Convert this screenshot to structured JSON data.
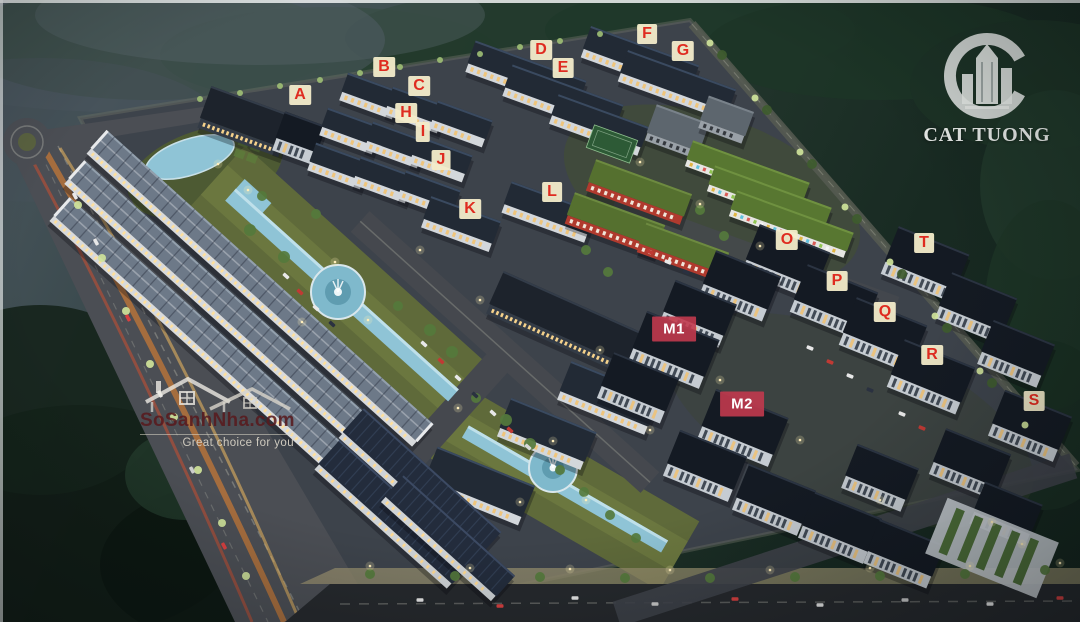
{
  "branding": {
    "logo_text": "CAT TUONG",
    "logo_icon": "circle-c-with-highrise-buildings",
    "logo_color": "#f2f4f2"
  },
  "watermark": {
    "site": "SoSanhNha.com",
    "tagline": "Great choice for you",
    "icon": "twin-house-outline",
    "site_color": "#581a1e",
    "tagline_color": "#d8d3c8"
  },
  "building_labels": {
    "letter_style": {
      "text_color": "#df2b20",
      "bg_color": "rgba(243,236,202,0.95)"
    },
    "block_style": {
      "text_color": "#ffffff",
      "bg_color": "rgba(193,58,78,0.9)"
    },
    "items": [
      {
        "id": "A",
        "label": "A",
        "x": 300,
        "y": 95,
        "style": "letter"
      },
      {
        "id": "B",
        "label": "B",
        "x": 384,
        "y": 67,
        "style": "letter"
      },
      {
        "id": "C",
        "label": "C",
        "x": 419,
        "y": 86,
        "style": "letter"
      },
      {
        "id": "D",
        "label": "D",
        "x": 541,
        "y": 50,
        "style": "letter"
      },
      {
        "id": "E",
        "label": "E",
        "x": 563,
        "y": 68,
        "style": "letter"
      },
      {
        "id": "F",
        "label": "F",
        "x": 647,
        "y": 34,
        "style": "letter"
      },
      {
        "id": "G",
        "label": "G",
        "x": 683,
        "y": 51,
        "style": "letter"
      },
      {
        "id": "H",
        "label": "H",
        "x": 406,
        "y": 113,
        "style": "letter"
      },
      {
        "id": "I",
        "label": "I",
        "x": 423,
        "y": 132,
        "style": "letter"
      },
      {
        "id": "J",
        "label": "J",
        "x": 441,
        "y": 160,
        "style": "letter"
      },
      {
        "id": "K",
        "label": "K",
        "x": 470,
        "y": 209,
        "style": "letter"
      },
      {
        "id": "L",
        "label": "L",
        "x": 552,
        "y": 192,
        "style": "letter"
      },
      {
        "id": "M1",
        "label": "M1",
        "x": 674,
        "y": 329,
        "style": "block"
      },
      {
        "id": "M2",
        "label": "M2",
        "x": 742,
        "y": 404,
        "style": "block"
      },
      {
        "id": "O",
        "label": "O",
        "x": 787,
        "y": 240,
        "style": "letter"
      },
      {
        "id": "P",
        "label": "P",
        "x": 837,
        "y": 281,
        "style": "letter"
      },
      {
        "id": "Q",
        "label": "Q",
        "x": 885,
        "y": 312,
        "style": "letter"
      },
      {
        "id": "R",
        "label": "R",
        "x": 932,
        "y": 355,
        "style": "letter"
      },
      {
        "id": "S",
        "label": "S",
        "x": 1034,
        "y": 401,
        "style": "letter"
      },
      {
        "id": "T",
        "label": "T",
        "x": 924,
        "y": 243,
        "style": "letter"
      }
    ]
  },
  "scene_colors": {
    "night_forest": "#1c3326",
    "ground": "#3d434b",
    "road": "#4b4e54",
    "canal_water": "#8fc4d6",
    "lawn": "#5f6a3a",
    "light_trail_orange": "#ff9634",
    "building_roof": "#222a35",
    "building_facade": "#d3d7db",
    "window_glow": "#f0c477"
  }
}
